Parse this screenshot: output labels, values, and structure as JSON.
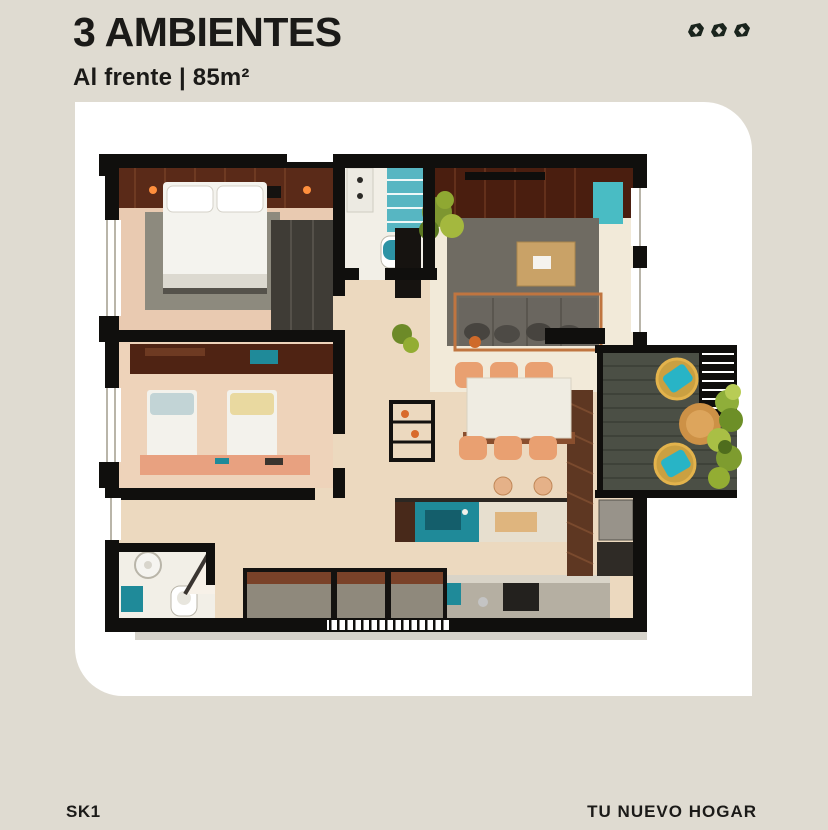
{
  "header": {
    "title": "3 AMBIENTES",
    "subtitle": "Al frente | 85m²"
  },
  "logo": {
    "icon": "leaf-mark",
    "count": 3,
    "color": "#1a241d"
  },
  "footer": {
    "left": "SK1",
    "right": "TU NUEVO HOGAR"
  },
  "colors": {
    "bg": "#dfdbd1",
    "card": "#ffffff",
    "ink": "#1b1a18",
    "wall": "#100f0d",
    "teal": "#1f8a99",
    "salmon": "#e8a180",
    "peach": "#e9a071"
  },
  "floorplan": {
    "type": "apartment-top-view-render",
    "rooms": [
      "master-bedroom",
      "ensuite-bathroom",
      "living-room",
      "hallway",
      "second-bedroom",
      "small-bathroom",
      "dining-area",
      "kitchen",
      "balcony"
    ]
  }
}
